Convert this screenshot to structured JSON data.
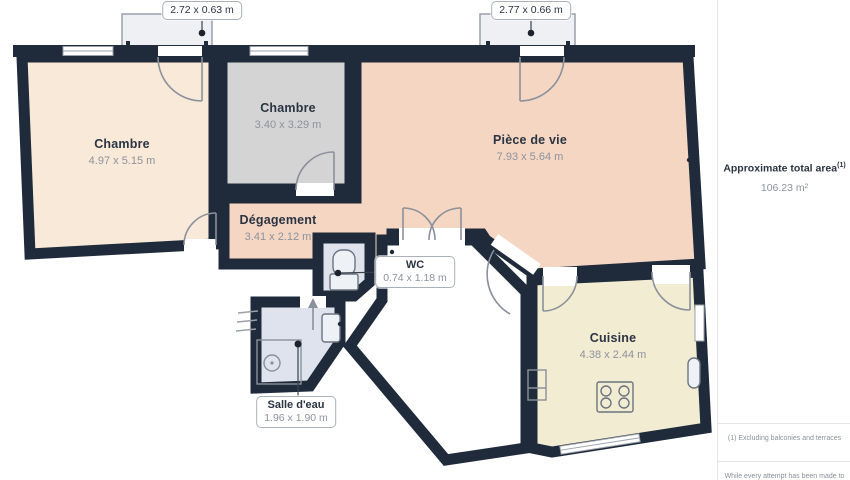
{
  "floorplan": {
    "balconies": [
      {
        "dims": "2.72 x 0.63 m"
      },
      {
        "dims": "2.77 x 0.66 m"
      }
    ],
    "rooms": [
      {
        "name": "Chambre",
        "dims": "4.97 x 5.15 m"
      },
      {
        "name": "Chambre",
        "dims": "3.40 x 3.29 m"
      },
      {
        "name": "Pièce de vie",
        "dims": "7.93 x 5.64 m"
      },
      {
        "name": "Dégagement",
        "dims": "3.41 x 2.12 m"
      },
      {
        "name": "WC",
        "dims": "0.74 x 1.18 m"
      },
      {
        "name": "Salle d'eau",
        "dims": "1.96 x 1.90 m"
      },
      {
        "name": "Cuisine",
        "dims": "4.38 x 2.44 m"
      }
    ]
  },
  "sidebar": {
    "area_title": "Approximate total area",
    "area_superscript": "(1)",
    "area_value": "106.23 m²",
    "footnote1": "(1) Excluding balconies and terraces",
    "footnote2": "While every attempt has been made to"
  },
  "colors": {
    "wall": "#1f2b3a",
    "room_chambre_left": "#f8e9d8",
    "room_chambre_mid": "#d4d4d5",
    "room_living": "#f4d6c2",
    "room_wet": "#dfe3ed",
    "room_kitchen": "#f2ecd3",
    "balcony": "#eef0f4",
    "door_stroke": "#8b919b",
    "label_dark": "#2b3442",
    "label_gray": "#8d939d"
  }
}
